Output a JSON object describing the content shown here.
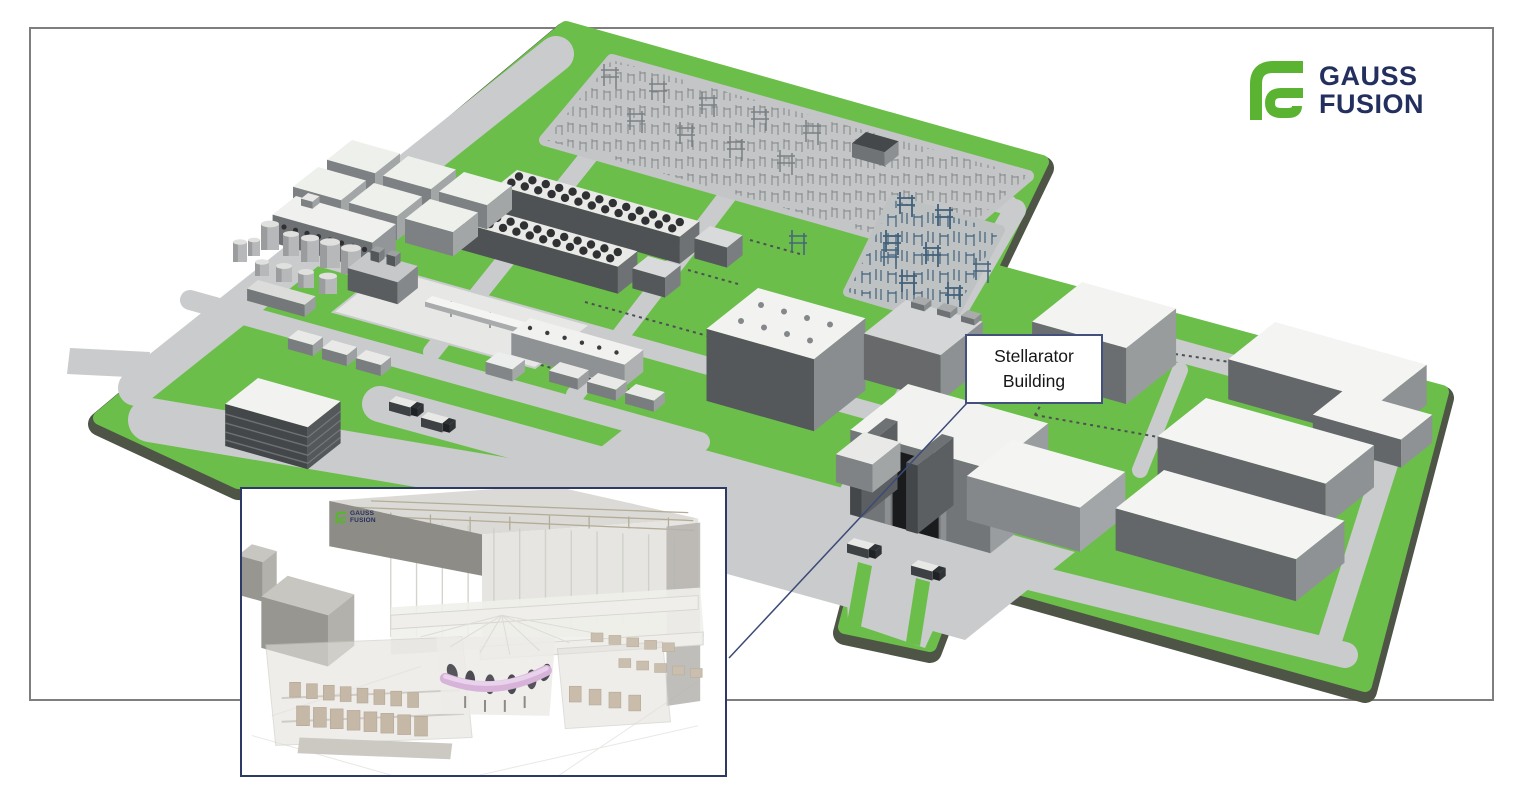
{
  "figure": {
    "frame_color": "#7e7e7e"
  },
  "logo": {
    "icon": "gauss-fusion-logomark-icon",
    "line1": "GAUSS",
    "line2": "FUSION",
    "icon_color": "#5ab431",
    "text_color": "#232f5e"
  },
  "callout": {
    "line1": "Stellarator",
    "line2": "Building",
    "border_color": "#44507c",
    "text_color": "#161616"
  },
  "inset": {
    "border_color": "#2e3a66",
    "logo_line1": "GAUSS",
    "logo_line2": "FUSION"
  },
  "palette": {
    "site_green": "#6cbe4b",
    "rim_dark": "#4e5446",
    "road_gray": "#c9cbcc",
    "pad_gray": "#c3c5c6",
    "roof_white": "#f2f3f1",
    "wall_dark": "#5f6365",
    "wall_mid": "#949798",
    "plasma_pink": "#d9b7dd",
    "steel_blue": "#47657e"
  }
}
